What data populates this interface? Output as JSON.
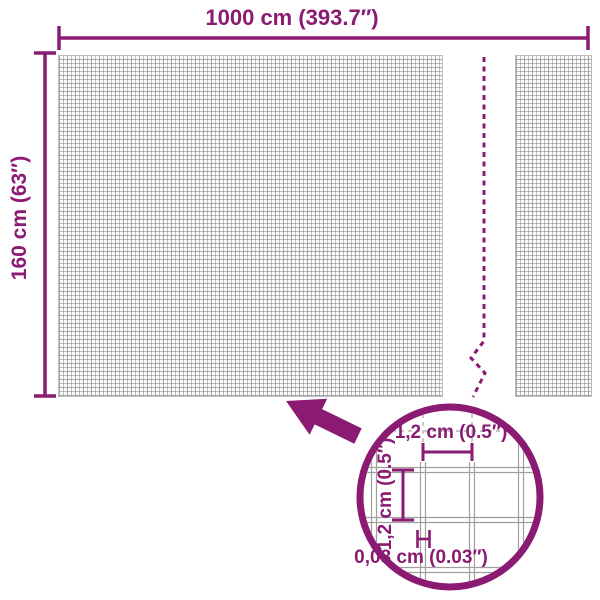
{
  "diagram": {
    "type": "product-dimension-diagram",
    "subject": "mesh fence roll",
    "colors": {
      "accent_purple": "#8A1A72",
      "mesh_grid_gray": "#9e9e9e",
      "detail_wire_gray": "#9f9f9f",
      "background": "#ffffff"
    },
    "overall": {
      "width_label": "1000 cm (393.7″)",
      "height_label": "160 cm (63″)"
    },
    "detail": {
      "mesh_opening_width_label": "1,2 cm (0.5″)",
      "mesh_opening_height_label": "1,2 cm (0.5″)",
      "wire_thickness_label": "0,08 cm (0.03″)"
    }
  }
}
